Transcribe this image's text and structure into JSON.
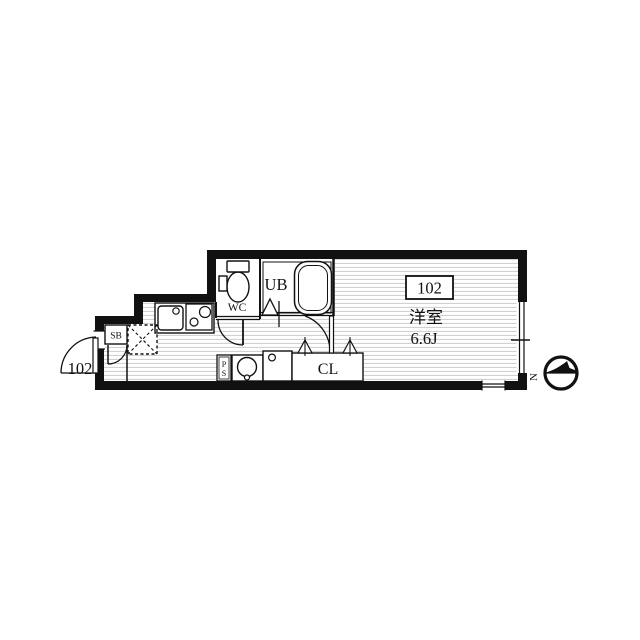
{
  "floor_plan": {
    "unit_number": "102",
    "main_room": {
      "type_label": "洋室",
      "size_label": "6.6J"
    },
    "rooms": {
      "unit_bath": "UB",
      "toilet": "WC",
      "closet": "CL",
      "shoe_box": "SB",
      "pipe_space": "PS"
    },
    "compass": {
      "north_label": "N"
    },
    "colors": {
      "wall": "#111111",
      "line": "#1a1a1a",
      "hatch": "#cccccc",
      "background": "#ffffff"
    }
  }
}
